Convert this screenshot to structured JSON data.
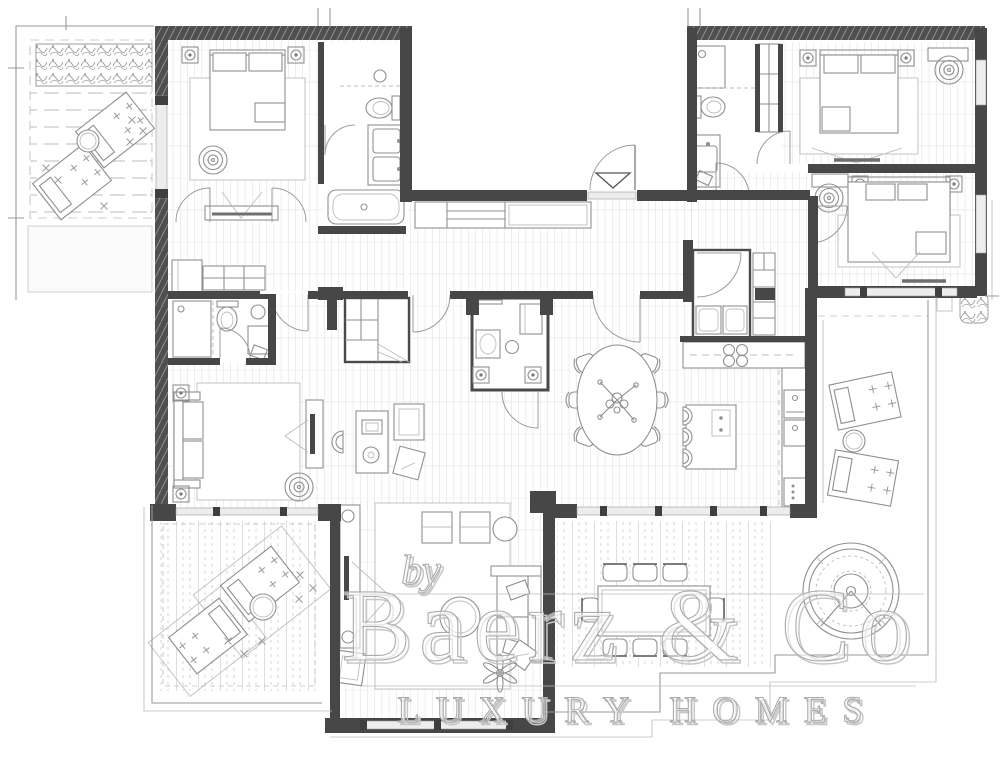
{
  "watermark": {
    "prefix": "by",
    "brand": "Baerz & Co",
    "tagline": "LUXURY HOMES"
  },
  "palette": {
    "background": "#ffffff",
    "walls": "#474747",
    "linework": "#8f8f8f",
    "light_linework": "#bdbdbd",
    "glazing": "#ededed",
    "watermark_stroke": "#ababab",
    "accent_red": "#c0392b"
  }
}
